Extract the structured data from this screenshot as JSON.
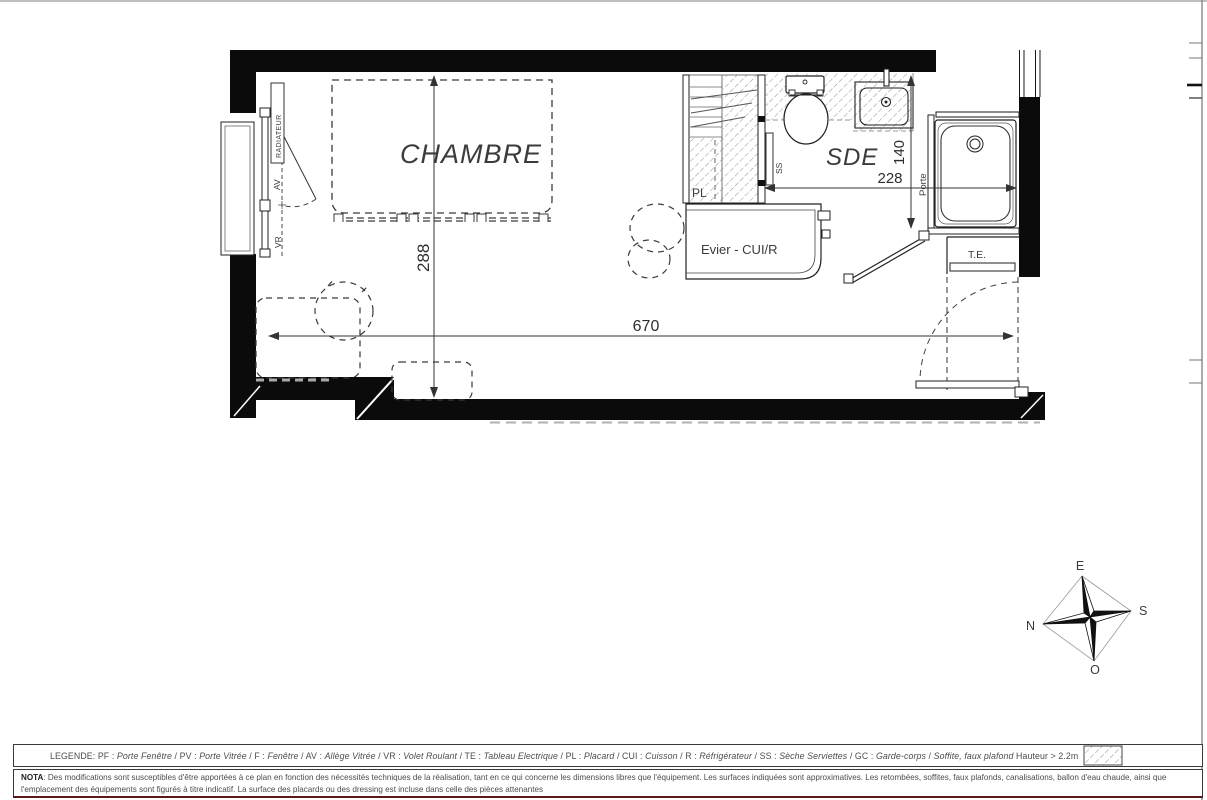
{
  "plan": {
    "room_chambre": "CHAMBRE",
    "room_sde": "SDE",
    "label_evier": "Evier - CUI/R",
    "label_te": "T.E.",
    "label_pl": "PL",
    "label_ss": "SS",
    "label_av": "AV",
    "label_vr": "VR",
    "label_radiateur": "RADIATEUR",
    "label_porte": "Porte",
    "dim_width": "670",
    "dim_depth": "288",
    "dim_sde_width": "228",
    "dim_sde_door": "140"
  },
  "compass": {
    "north": "N",
    "east": "E",
    "south": "S",
    "west": "O"
  },
  "legend": {
    "title": "LEGENDE:",
    "items": [
      {
        "abbr": "PF",
        "term": "Porte Fenêtre"
      },
      {
        "abbr": "PV",
        "term": "Porte Vitrée"
      },
      {
        "abbr": "F",
        "term": "Fenêtre"
      },
      {
        "abbr": "AV",
        "term": "Allège Vitrée"
      },
      {
        "abbr": "VR",
        "term": "Volet Roulant"
      },
      {
        "abbr": "TE",
        "term": "Tableau Electrique"
      },
      {
        "abbr": "PL",
        "term": "Placard"
      },
      {
        "abbr": "CUI",
        "term": "Cuisson"
      },
      {
        "abbr": "R",
        "term": "Réfrigérateur"
      },
      {
        "abbr": "SS",
        "term": "Sèche Serviettes"
      },
      {
        "abbr": "GC",
        "term": "Garde-corps"
      },
      {
        "abbr": "",
        "term": "Soffite, faux plafond"
      }
    ],
    "height_note": "Hauteur > 2.2m"
  },
  "nota": {
    "label": "NOTA",
    "text": ": Des modifications sont susceptibles d'être apportées à ce plan en fonction des nécessités techniques de la réalisation, tant en ce qui concerne les dimensions libres que l'équipement. Les surfaces indiquées sont approximatives. Les retombées, soffites, faux plafonds, canalisations, ballon d'eau chaude, ainsi que l'emplacement des équipements sont figurés à titre indicatif. La surface des placards ou des dressing est incluse dans celle des pièces attenantes"
  }
}
